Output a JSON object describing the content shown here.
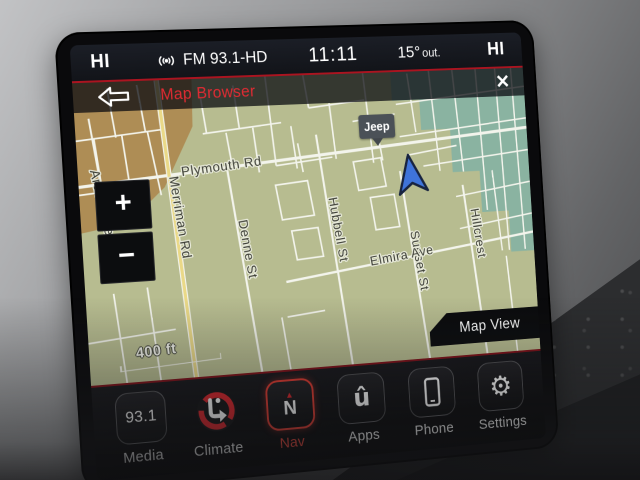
{
  "status_bar": {
    "driver_temp": "HI",
    "radio_station": "FM 93.1-HD",
    "time": "11:11",
    "outside_temp": "15°",
    "outside_unit": "out.",
    "passenger_temp": "HI"
  },
  "map_header": {
    "title": "Map Browser",
    "close_glyph": "✕"
  },
  "map": {
    "streets": [
      {
        "name": "Plymouth Rd"
      },
      {
        "name": "Merriman Rd"
      },
      {
        "name": "Arden Ave"
      },
      {
        "name": "Denne St"
      },
      {
        "name": "Hubbell St"
      },
      {
        "name": "Sunset St"
      },
      {
        "name": "Elmira Ave"
      },
      {
        "name": "Hillcrest"
      }
    ],
    "marker_label": "Jeep",
    "scale_label": "400 ft",
    "zoom_in_glyph": "+",
    "zoom_out_glyph": "−",
    "map_view_label": "Map View"
  },
  "dock": {
    "items": [
      {
        "label": "Media",
        "value": "93.1"
      },
      {
        "label": "Climate"
      },
      {
        "label": "Nav",
        "compass_letter": "N",
        "compass_glyph": "▲",
        "active": true
      },
      {
        "label": "Apps",
        "glyph": "û"
      },
      {
        "label": "Phone"
      },
      {
        "label": "Settings",
        "glyph": "⚙"
      }
    ]
  },
  "colors": {
    "accent_red": "#ab1420",
    "nav_active_red": "#e03a30",
    "map_olive": "#b7bc90",
    "map_tan": "#ae8d55",
    "map_teal": "#8ab3a1",
    "road_yellow": "#ead987",
    "nav_arrow_blue": "#3f74da"
  }
}
